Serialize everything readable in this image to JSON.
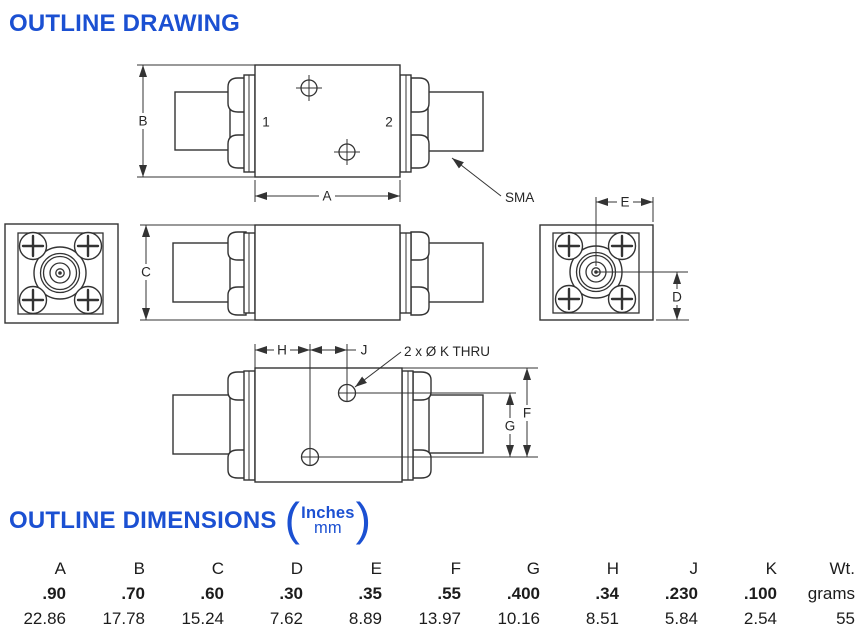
{
  "header": {
    "drawing_title": "OUTLINE DRAWING",
    "dimensions_title": "OUTLINE DIMENSIONS",
    "units_primary": "Inches",
    "units_secondary": "mm",
    "paren_open": "(",
    "paren_close": ")"
  },
  "drawing": {
    "dim_labels": {
      "A": "A",
      "B": "B",
      "C": "C",
      "D": "D",
      "E": "E",
      "F": "F",
      "G": "G",
      "H": "H",
      "J": "J"
    },
    "port_labels": {
      "port1": "1",
      "port2": "2"
    },
    "connector_label": "SMA",
    "hole_note": "2 x Ø K THRU"
  },
  "table": {
    "columns": [
      "A",
      "B",
      "C",
      "D",
      "E",
      "F",
      "G",
      "H",
      "J",
      "K",
      "Wt."
    ],
    "rows": {
      "inches": [
        ".90",
        ".70",
        ".60",
        ".30",
        ".35",
        ".55",
        ".400",
        ".34",
        ".230",
        ".100",
        "grams"
      ],
      "mm": [
        "22.86",
        "17.78",
        "15.24",
        "7.62",
        "8.89",
        "13.97",
        "10.16",
        "8.51",
        "5.84",
        "2.54",
        "55"
      ]
    }
  },
  "colors": {
    "accent_blue": "#1b50d2",
    "line_color": "#333333"
  }
}
